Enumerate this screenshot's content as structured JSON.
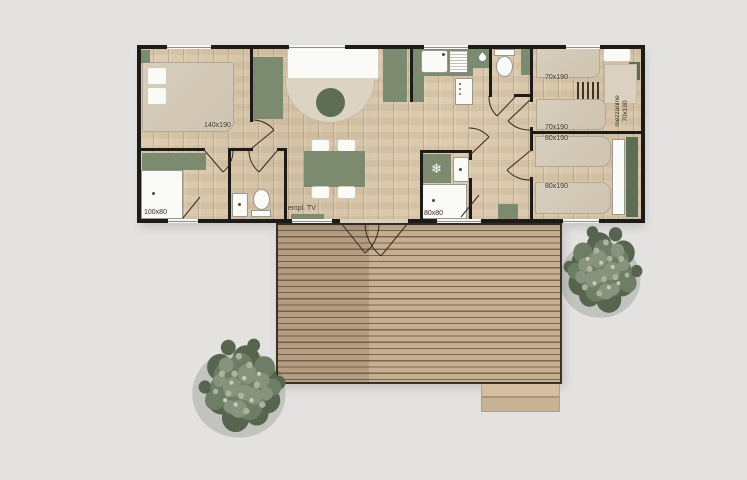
{
  "scene": {
    "type": "mobile-home floor plan with deck"
  },
  "colors": {
    "background": "#e3e2e0",
    "wall": "#1d1b18",
    "green": "#7c8a70",
    "green_dark": "#5e6e55",
    "label": "#3b352c",
    "floor_wood": "#d6c3a7",
    "deck_wood": "#c6ae90",
    "tree_green": "#6e7d65"
  },
  "floorplan": {
    "master_bedroom": {
      "bed_size": "140x190"
    },
    "master_bathroom": {
      "shower_size": "100x80"
    },
    "living_room": {
      "tv_spot": "empl. TV"
    },
    "bathroom_2": {
      "shower_size": "80x80"
    },
    "bedroom_2": {
      "bed_top_size": "70x190",
      "bed_bottom_size": "70x190",
      "mezzanine_line_1": "mezzanine",
      "mezzanine_line_2": "70x190"
    },
    "bedroom_3": {
      "bed_top_size": "80x190",
      "bed_bottom_size": "80x190"
    }
  },
  "icons": {
    "fridge_glyph": "❄"
  }
}
